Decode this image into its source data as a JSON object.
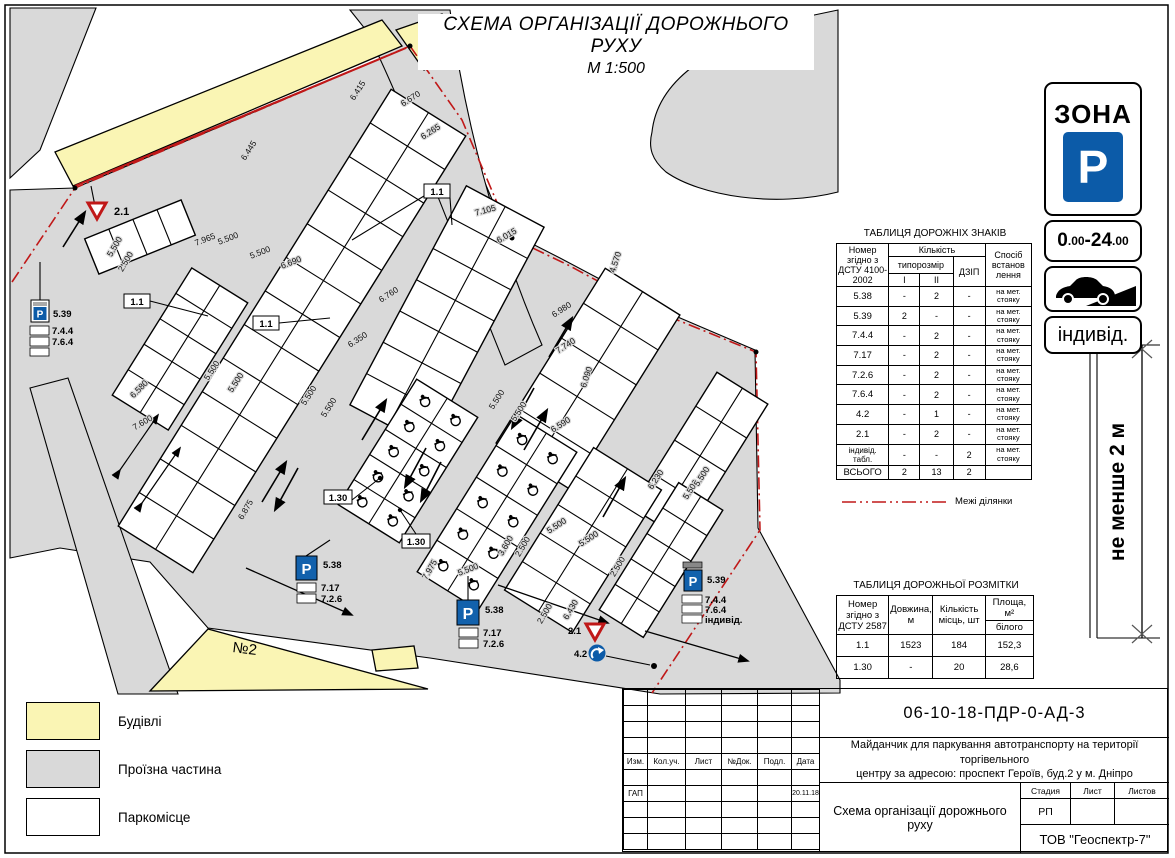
{
  "title": {
    "line1": "СХЕМА ОРГАНІЗАЦІЇ ДОРОЖНЬОГО РУХУ",
    "line2": "М 1:500"
  },
  "zone_sign": {
    "zona": "ЗОНА",
    "p": "P",
    "t1": "0",
    "t2": ".00",
    "t3": "-24",
    "t4": ".00",
    "individ": "індивід.",
    "note": "не менше 2 м",
    "blue": "#0c5ba8"
  },
  "signs_table": {
    "title": "ТАБЛИЦЯ ДОРОЖНІХ ЗНАКІВ",
    "col_number": "Номер згідно з ДСТУ 4100-2002",
    "col_qty": "Кількість",
    "col_size": "типорозмір",
    "col_i": "I",
    "col_ii": "II",
    "col_dzip": "ДЗІП",
    "col_method": "Спосіб встанов лення",
    "rows": [
      {
        "n": "5.38",
        "i": "-",
        "ii": "2",
        "d": "-",
        "m": "на мет. стояку"
      },
      {
        "n": "5.39",
        "i": "2",
        "ii": "-",
        "d": "-",
        "m": "на мет. стояку"
      },
      {
        "n": "7.4.4",
        "i": "-",
        "ii": "2",
        "d": "-",
        "m": "на мет. стояку"
      },
      {
        "n": "7.17",
        "i": "-",
        "ii": "2",
        "d": "-",
        "m": "на мет. стояку"
      },
      {
        "n": "7.2.6",
        "i": "-",
        "ii": "2",
        "d": "-",
        "m": "на мет. стояку"
      },
      {
        "n": "7.6.4",
        "i": "-",
        "ii": "2",
        "d": "-",
        "m": "на мет. стояку"
      },
      {
        "n": "4.2",
        "i": "-",
        "ii": "1",
        "d": "-",
        "m": "на мет. стояку"
      },
      {
        "n": "2.1",
        "i": "-",
        "ii": "2",
        "d": "-",
        "m": "на мет. стояку"
      },
      {
        "n": "індивід. табл.",
        "i": "-",
        "ii": "-",
        "d": "2",
        "m": "на мет. стояку"
      },
      {
        "n": "ВСЬОГО",
        "i": "2",
        "ii": "13",
        "d": "2",
        "m": ""
      }
    ]
  },
  "boundary_legend": "Межі ділянки",
  "boundary_color": "#c01818",
  "markings_table": {
    "title": "ТАБЛИЦЯ ДОРОЖНЬОЇ РОЗМІТКИ",
    "col_number": "Номер згідно з ДСТУ 2587",
    "col_length": "Довжина, м",
    "col_qty": "Кількість місць, шт",
    "col_area": "Площа, м²",
    "col_area_sub": "білого",
    "rows": [
      {
        "n": "1.1",
        "len": "1523",
        "qty": "184",
        "area": "152,3"
      },
      {
        "n": "1.30",
        "len": "-",
        "qty": "20",
        "area": "28,6"
      }
    ]
  },
  "legend": {
    "items": [
      {
        "label": "Будівлі",
        "color": "#faf5b4"
      },
      {
        "label": "Проїзна частина",
        "color": "#d9d9d9"
      },
      {
        "label": "Паркомісце",
        "color": "#ffffff"
      }
    ]
  },
  "title_block": {
    "doc_number": "06-10-18-ПДР-0-АД-3",
    "description_line1": "Майданчик для паркування автотранспорту на території торгівельного",
    "description_line2": "центру за адресою: проспект Героїв, буд.2 у м. Дніпро",
    "col_izm": "Изм.",
    "col_koluch": "Кол.уч.",
    "col_list": "Лист",
    "col_ndok": "№Док.",
    "col_podp": "Подл.",
    "col_data": "Дата",
    "gap": "ГАП",
    "date": "20.11.18",
    "stage_label": "Стадия",
    "sheet_label": "Лист",
    "sheets_label": "Листов",
    "stage": "РП",
    "scheme_title": "Схема організації дорожнього руху",
    "company": "ТОВ \"Геоспектр-7\""
  },
  "plan": {
    "building_label": "№2",
    "dims": [
      "6.415",
      "6.670",
      "6.265",
      "7.105",
      "6.015",
      "4.570",
      "7.965",
      "5.500",
      "5.500",
      "6.690",
      "5.500",
      "2.500",
      "6.445",
      "6.760",
      "6.350",
      "6.980",
      "7.740",
      "6.090",
      "6.590",
      "6.230",
      "5.500",
      "5.500",
      "5.500",
      "5.500",
      "5.500",
      "5.500",
      "5.500",
      "6.580",
      "7.600",
      "6.875",
      "3.600",
      "2.500",
      "2.500",
      "2.500",
      "5.500",
      "5.500",
      "6.430",
      "7.975",
      "5.500",
      "5.500",
      "1.1",
      "1.1",
      "1.1",
      "1.30",
      "1.30"
    ],
    "stacks": {
      "p": "P",
      "s1": {
        "sign": "5.39",
        "a": "7.4.4",
        "b": "7.6.4"
      },
      "s2": {
        "sign": "5.38",
        "a": "7.17",
        "b": "7.2.6"
      },
      "s3": {
        "sign": "5.38",
        "a": "7.17",
        "b": "7.2.6"
      },
      "s4": {
        "sign": "5.39",
        "a": "7.4.4",
        "b": "7.6.4",
        "c": "індивід."
      },
      "give_way_top": "2.1",
      "give_way_bottom": "2.1",
      "direction": "4.2"
    }
  }
}
